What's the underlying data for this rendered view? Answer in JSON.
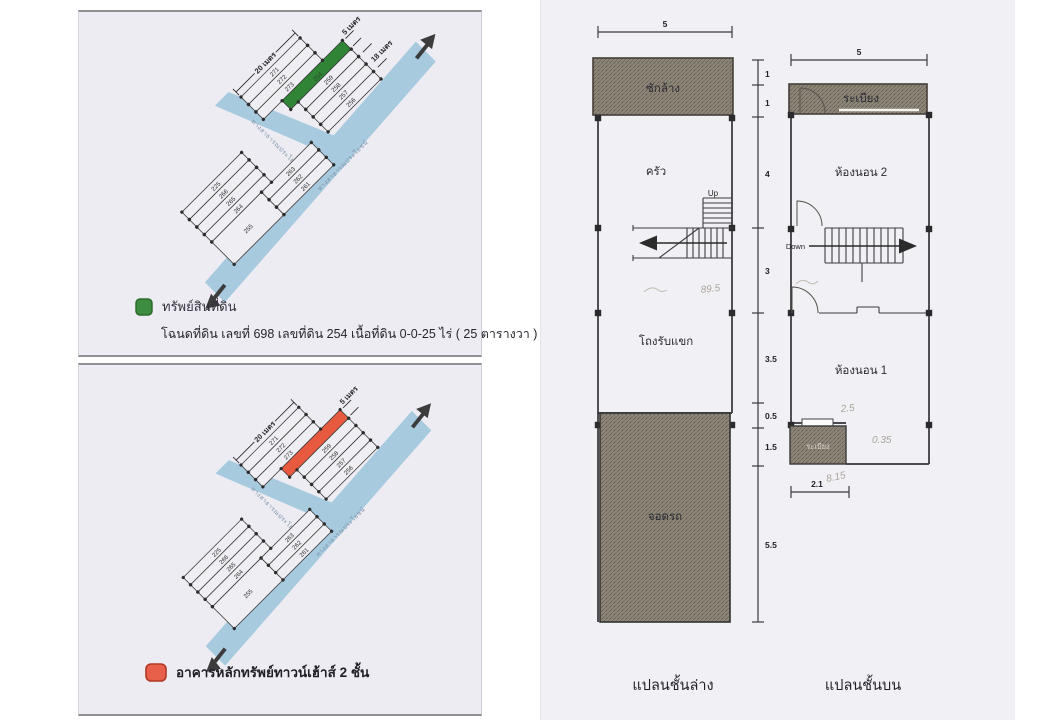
{
  "legend_top": {
    "swatch_color": "#3d8c41",
    "title": "ทรัพย์สินที่ดิน",
    "detail": "โฉนดที่ดิน เลขที่ 698 เลขที่ดิน 254 เนื้อที่ดิน 0-0-25 ไร่ ( 25 ตารางวา )"
  },
  "legend_bottom": {
    "swatch_color": "#e8604a",
    "title": "อาคารหลักทรัพย์ทาวน์เฮ้าส์ 2 ชั้น"
  },
  "map": {
    "dim_20m": "20 เมตร",
    "dim_5m": "5 เมตร",
    "dim_18m": "18 เมตร",
    "road_a_label": "ทางสาธารณประโยชน์",
    "road_b_label": "ทางสาธารณประโยชน์",
    "road_color": "#a7cadf",
    "highlight_green": "#2f8435",
    "highlight_orange": "#e85a40",
    "highlight_plot_no": "254",
    "plots_upper": [
      "271",
      "272",
      "273"
    ],
    "plots_right": [
      "259",
      "258",
      "257",
      "256"
    ],
    "plots_left": [
      "225",
      "266",
      "265",
      "264"
    ],
    "plots_mid": [
      "263",
      "262",
      "261"
    ],
    "plot_bottom": "255"
  },
  "floorplan_lower": {
    "caption": "แปลนชั้นล่าง",
    "dim_top": "5",
    "room_wash": "ซักล้าง",
    "room_kitchen": "ครัว",
    "room_hall": "โถงรับแขก",
    "room_parking": "จอดรถ",
    "stair_label": "Up",
    "dims_right": [
      "1",
      "1",
      "4",
      "3",
      "3.5",
      "0.5",
      "1.5",
      "5.5"
    ],
    "pencil_note": "89.5"
  },
  "floorplan_upper": {
    "caption": "แปลนชั้นบน",
    "dim_top": "5",
    "room_balcony_top": "ระเบียง",
    "room_bed2": "ห้องนอน 2",
    "room_bed1": "ห้องนอน 1",
    "room_balcony_bottom": "ระเบียง",
    "stair_label": "Down",
    "dim_bottom": "2.1",
    "pencil_notes": [
      "2.5",
      "0.35",
      "8.15"
    ]
  }
}
